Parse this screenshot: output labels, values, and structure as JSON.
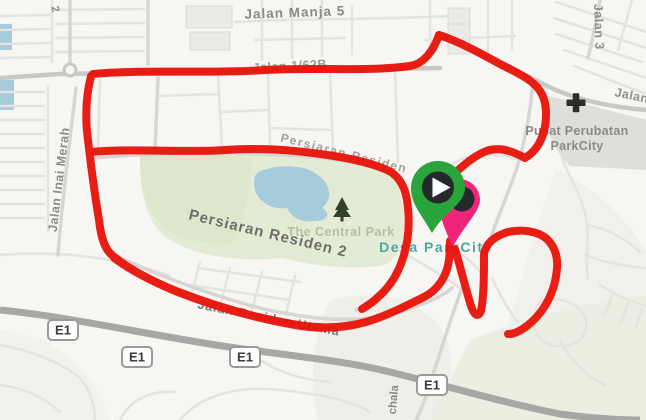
{
  "app": {
    "type": "map-activity-view"
  },
  "map_labels": {
    "jalan_manja_5": "Jalan Manja 5",
    "jalan_1_62b": "Jalan 1/62B",
    "jalan_inai_merah": "Jalan Inai Merah",
    "jalan_3": "Jalan 3",
    "jalan_right": "Jalan",
    "pusat_perubatan_line1": "Pusat Perubatan",
    "pusat_perubatan_line2": "ParkCity",
    "persiaran_residen": "Persiaran Residen",
    "persiaran_residen_2": "Persiaran Residen 2",
    "the_central_park": "The Central Park",
    "desa_parkcity": "Desa ParkCity",
    "jalan_residen_utama": "Jalan Residen Utama",
    "chala_partial": "chala",
    "street_2_partial": "2"
  },
  "highway": {
    "shield_label": "E1"
  },
  "route": {
    "color": "#e8130a",
    "description": "Recorded GPS activity track drawn over the map"
  },
  "markers": {
    "start": {
      "icon": "play-icon",
      "pin_color": "#2aa53b",
      "disc_color": "#24292c",
      "glyph_color": "#ffffff"
    },
    "end": {
      "icon": "location-pin-icon",
      "pin_color": "#ee2578",
      "disc_color": "#24292c"
    }
  },
  "map_colors": {
    "background": "#f7f6f3",
    "park": "#e4ebd5",
    "park_dark": "#dde6cb",
    "water": "#a6cbda",
    "label_teal": "#49a7a0",
    "highway": "#a8a7a5"
  }
}
